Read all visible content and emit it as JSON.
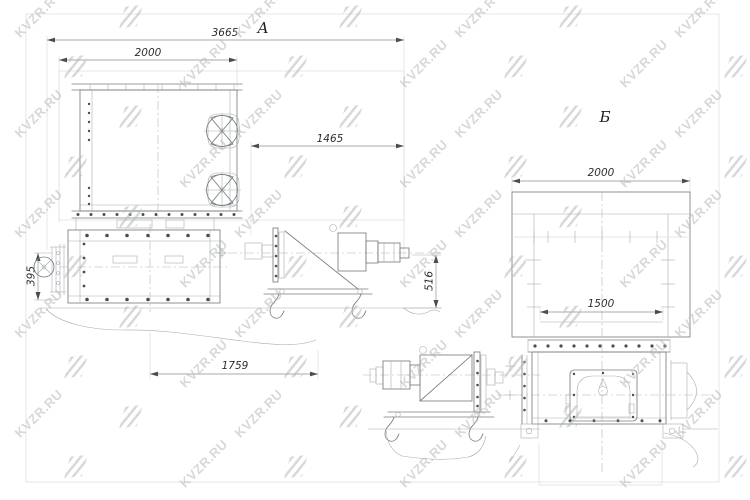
{
  "watermark": {
    "text": "KVZR.RU",
    "color": "#b6b9bb"
  },
  "colors": {
    "main_line": "#787d80",
    "light_line": "#a9adb0",
    "dim_text": "#2e2e2e"
  },
  "views": {
    "a": {
      "label": "А",
      "dim_3665": "3665",
      "dim_2000": "2000",
      "dim_1465": "1465",
      "dim_516": "516",
      "dim_395": "395",
      "dim_1759": "1759"
    },
    "b": {
      "label": "Б",
      "dim_2000": "2000",
      "dim_1500": "1500"
    }
  }
}
